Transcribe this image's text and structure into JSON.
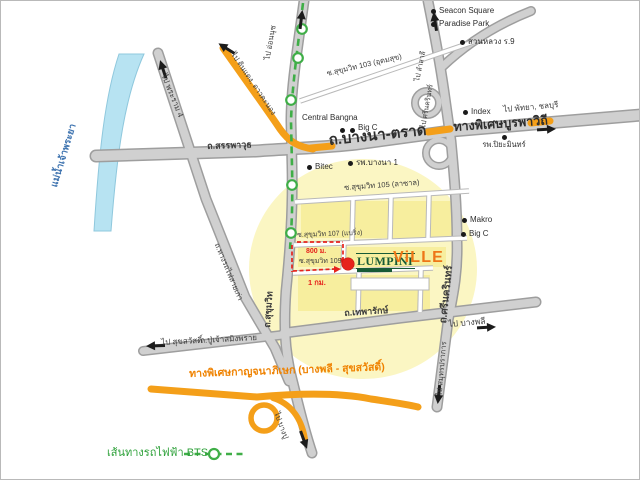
{
  "map": {
    "project": {
      "brand": "LUMPINI",
      "series": "ViLLE"
    },
    "river": {
      "name": "แม่น้ำเจ้าพระยา"
    },
    "legend": {
      "bts": "เส้นทางรถไฟฟ้า BTS"
    },
    "distances": {
      "from_bts": "800 ม.",
      "from_sukhumvit": "1 กม."
    },
    "roads": {
      "sanphawut": "ถ.สรรพาวุธ",
      "bangna_trad": "ถ.บางนา-ตราด",
      "burapha_withi": "ทางพิเศษบูรพาวิถี",
      "to_pattaya": "ไป พัทยา, ชลบุรี",
      "soi103": "ซ.สุขุมวิท 103 (อุดมสุข)",
      "soi105": "ซ.สุขุมวิท 105 (ลาซาล)",
      "soi107": "ซ.สุขุมวิท 107 (แบริ่ง)",
      "soi109": "ซ.สุขุมวิท 109",
      "sukhumvit": "ถ.สุขุมวิท",
      "srinakarin": "ถ.ศรีนครินทร์",
      "to_samutprakan": "ไป สมุทรปราการ",
      "thepharak": "ถ.เทพารักษ์",
      "to_bangphli": "ไป บางพลี",
      "puchao": "ถ.ปู่เจ้าสมิงพราย",
      "to_suksawat": "ไป สุขสวัสดิ์",
      "kanchanaphisek": "ทางพิเศษกาญจนาภิเษก (บางพลี - สุขสวัสดิ์)",
      "to_bangpu": "ไป บางปู",
      "to_rama4": "ไป พระราม 4",
      "old_railway": "ถ.ทางรถไฟสายเก่า",
      "to_dindaeng": "ไป ดินแดง, ดาวคะนอง",
      "to_onnut": "ไป อ่อนนุช",
      "to_lamsali": "ไป ลำสาลี",
      "to_srinakarin": "ไป ศรีนครินทร์"
    },
    "pois": [
      {
        "name": "Seacon Square"
      },
      {
        "name": "Paradise Park"
      },
      {
        "name": "สวนหลวง ร.9"
      },
      {
        "name": "Central Bangna"
      },
      {
        "name": "Big C"
      },
      {
        "name": "Index"
      },
      {
        "name": "รพ.ปิยะมินทร์"
      },
      {
        "name": "Bitec"
      },
      {
        "name": "รพ.บางนา 1"
      },
      {
        "name": "Makro"
      },
      {
        "name": "Big C"
      }
    ],
    "colors": {
      "expressway_orange": "#f49f19",
      "bts_green": "#3fae47",
      "route_red": "#e6231c",
      "highlight_yellow": "#fbf6c3",
      "river_blue": "#b7e3f2",
      "brand_green": "#175a36",
      "brand_orange": "#ee7617"
    }
  }
}
